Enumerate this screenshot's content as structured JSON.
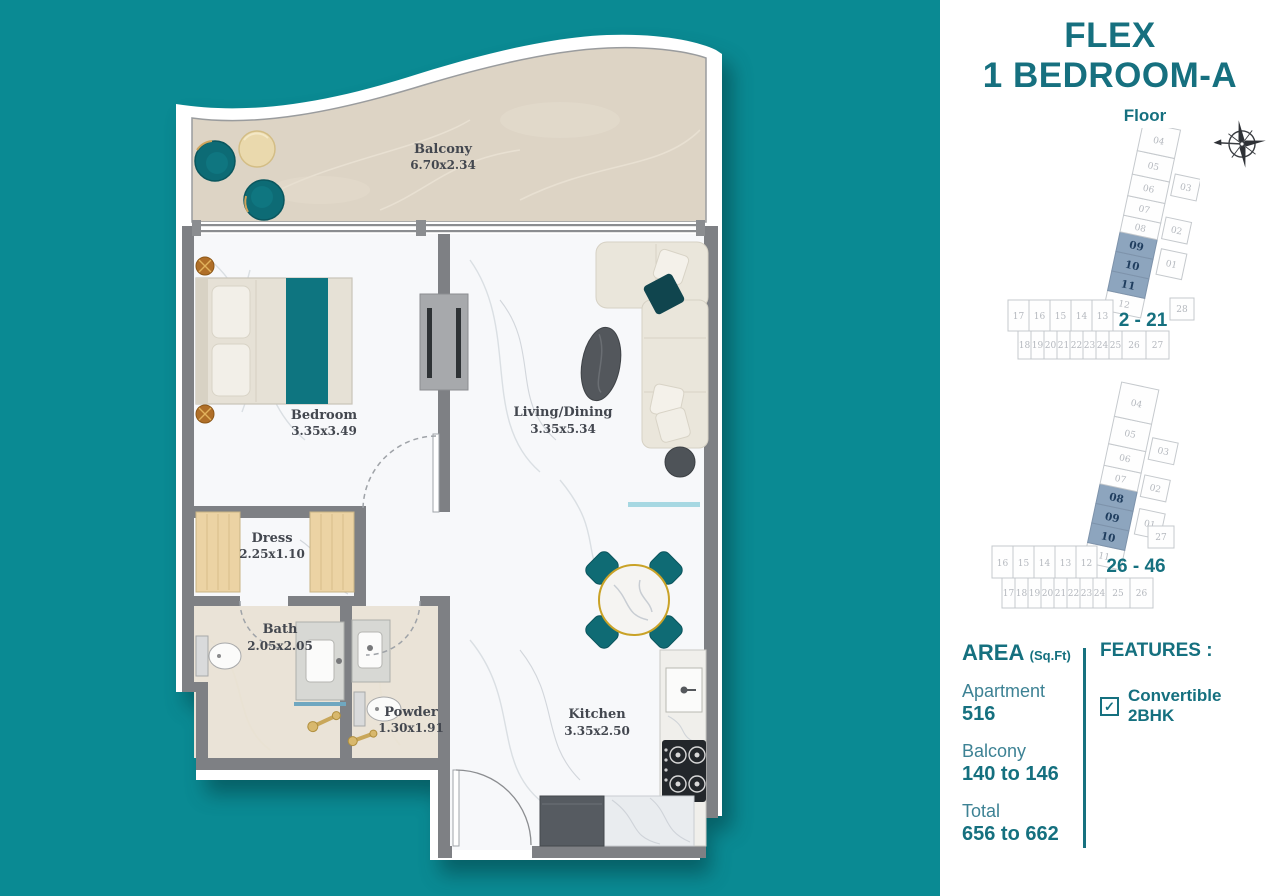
{
  "colors": {
    "background_teal": "#0a8a93",
    "accent_teal": "#16707f",
    "label_teal": "#3d8294",
    "highlight_unit_fill": "#8da5be",
    "highlight_unit_text": "#1f3d5e",
    "wall_gray": "#7e8084",
    "balcony_floor": "#ddd4c5",
    "furniture_teal": "#0d6b75"
  },
  "title": {
    "line1": "FLEX",
    "line2": "1 BEDROOM-A"
  },
  "floor_label": "Floor",
  "icons": {
    "compass": "compass-rose",
    "check_glyph": "✓"
  },
  "plates": [
    {
      "range": "2 - 21",
      "arm_units": [
        "04",
        "05",
        "06",
        "07",
        "08",
        "09",
        "10",
        "11",
        "12"
      ],
      "highlighted": [
        "09",
        "10",
        "11"
      ],
      "side_units": [
        "03",
        "02",
        "01"
      ],
      "row_top": [
        "17",
        "16",
        "15",
        "14",
        "13"
      ],
      "row_bottom": [
        "18",
        "19",
        "20",
        "21",
        "22",
        "23",
        "24",
        "25",
        "26",
        "27"
      ],
      "corner_unit": "28"
    },
    {
      "range": "26 - 46",
      "arm_units": [
        "04",
        "05",
        "06",
        "07",
        "08",
        "09",
        "10",
        "11"
      ],
      "highlighted": [
        "08",
        "09",
        "10"
      ],
      "side_units": [
        "03",
        "02",
        "01"
      ],
      "row_top": [
        "16",
        "15",
        "14",
        "13",
        "12"
      ],
      "row_bottom": [
        "17",
        "18",
        "19",
        "20",
        "21",
        "22",
        "23",
        "24",
        "25",
        "26"
      ],
      "corner_unit": "27"
    }
  ],
  "rooms": {
    "balcony": {
      "name": "Balcony",
      "dims": "6.70x2.34"
    },
    "bedroom": {
      "name": "Bedroom",
      "dims": "3.35x3.49"
    },
    "living": {
      "name": "Living/Dining",
      "dims": "3.35x5.34"
    },
    "dress": {
      "name": "Dress",
      "dims": "2.25x1.10"
    },
    "bath": {
      "name": "Bath",
      "dims": "2.05x2.05"
    },
    "powder": {
      "name": "Powder",
      "dims": "1.30x1.91"
    },
    "kitchen": {
      "name": "Kitchen",
      "dims": "3.35x2.50"
    }
  },
  "area": {
    "heading": "AREA",
    "unit": "(Sq.Ft)",
    "items": [
      {
        "label": "Apartment",
        "value": "516"
      },
      {
        "label": "Balcony",
        "value": "140 to 146"
      },
      {
        "label": "Total",
        "value": "656 to 662"
      }
    ]
  },
  "features": {
    "heading": "FEATURES :",
    "items": [
      {
        "label": "Convertible 2BHK",
        "checked": true
      }
    ]
  }
}
